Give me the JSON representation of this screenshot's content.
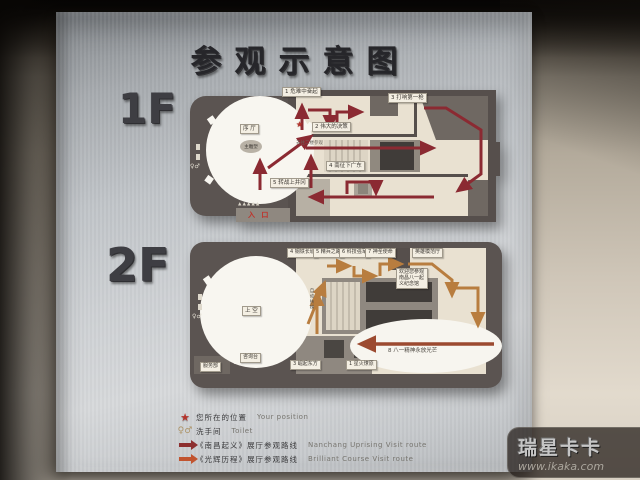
{
  "sign": {
    "title": "参观示意图",
    "floor1": {
      "label": "1F",
      "hall": "序 厅",
      "sculpture": "主雕塑",
      "entrance": "入 口",
      "canopy": "▲▲▲▲▲",
      "toilet_mark": "♀♂",
      "position_star": "★",
      "to2f_note": "去往二楼参观",
      "stations": [
        "1 危难中奋起",
        "2 伟大的决策",
        "3 打响第一枪",
        "4 南征下广东",
        "5 转战上井冈"
      ]
    },
    "floor2": {
      "label": "2F",
      "hall": "上 空",
      "escalator": "自动扶梯",
      "hero_hall": "英雄模范厅",
      "thanks": [
        "欢迎您参观",
        "南昌八一起",
        "义纪念馆"
      ],
      "service": "服务部",
      "info_desk": "咨询台",
      "toilet_mark": "♀♂",
      "stations": [
        "1 星火燎原",
        "3 崛起东方",
        "4 钢铁长城",
        "5 精兵之路",
        "6 科技强军",
        "7 神圣使命",
        "8 八一精神永放光芒"
      ]
    },
    "legend": {
      "star": "★",
      "toilet_icon": "♀♂",
      "items": [
        {
          "zh": "您所在的位置",
          "en": "Your position"
        },
        {
          "zh": "洗手间",
          "en": "Toilet"
        },
        {
          "zh": "《南昌起义》展厅参观路线",
          "en": "Nanchang Uprising Visit route"
        },
        {
          "zh": "《光辉历程》展厅参观路线",
          "en": "Brilliant Course Visit route"
        }
      ]
    }
  },
  "watermark": {
    "brand": "瑞星卡卡",
    "url": "www.ikaka.com"
  },
  "colors": {
    "route_1f": "#8b2a32",
    "route_2f": "#b87d3f",
    "star": "#b5342c",
    "panel": "#c7cbd0"
  }
}
